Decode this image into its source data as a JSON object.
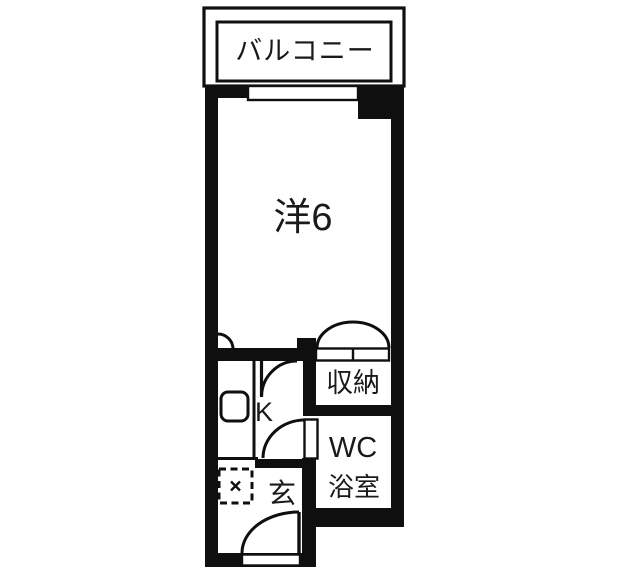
{
  "floorplan": {
    "title": "apartment-floorplan",
    "colors": {
      "background": "#ffffff",
      "wall": "#0f0f0f",
      "line": "#111111",
      "text": "#1a1a1a"
    },
    "rooms": {
      "balcony": {
        "label": "バルコニー"
      },
      "western_room": {
        "label": "洋6"
      },
      "storage": {
        "label": "収納"
      },
      "kitchen": {
        "label": "K"
      },
      "wc_bath": {
        "label_line1": "WC",
        "label_line2": "浴室"
      },
      "entrance": {
        "label": "玄"
      }
    }
  }
}
